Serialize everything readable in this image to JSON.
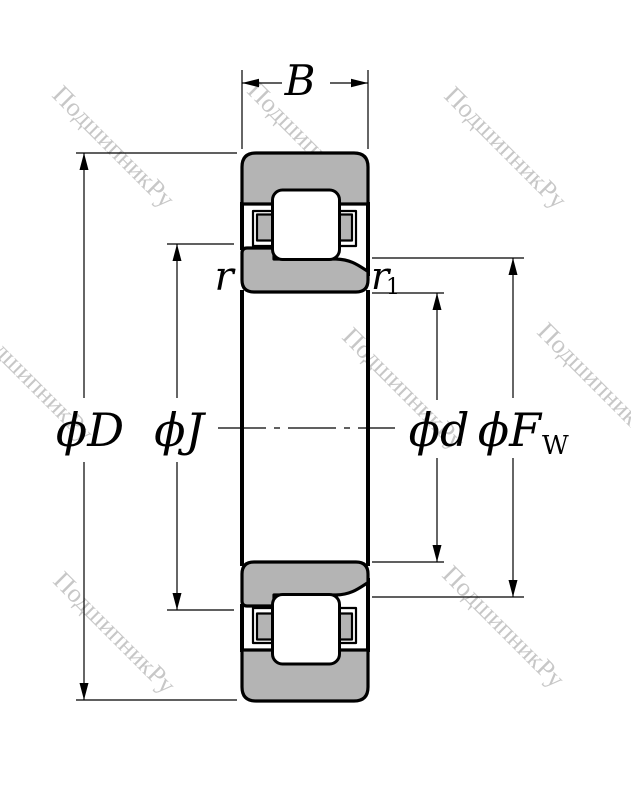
{
  "drawing": {
    "dimension_labels": {
      "width": "B",
      "outer_diameter": "ϕD",
      "inner_rib_diameter": "ϕJ",
      "bore_diameter": "ϕd",
      "raceway_diameter": "ϕF",
      "raceway_diameter_subscript": "W",
      "outer_chamfer": "r",
      "inner_chamfer": "r",
      "inner_chamfer_subscript": "1"
    },
    "watermark": {
      "text": "ПодшипникРу",
      "color": "#c7c7c7"
    },
    "colors": {
      "ring_fill": "#b4b4b4",
      "outline": "#000000",
      "background": "#ffffff"
    }
  }
}
